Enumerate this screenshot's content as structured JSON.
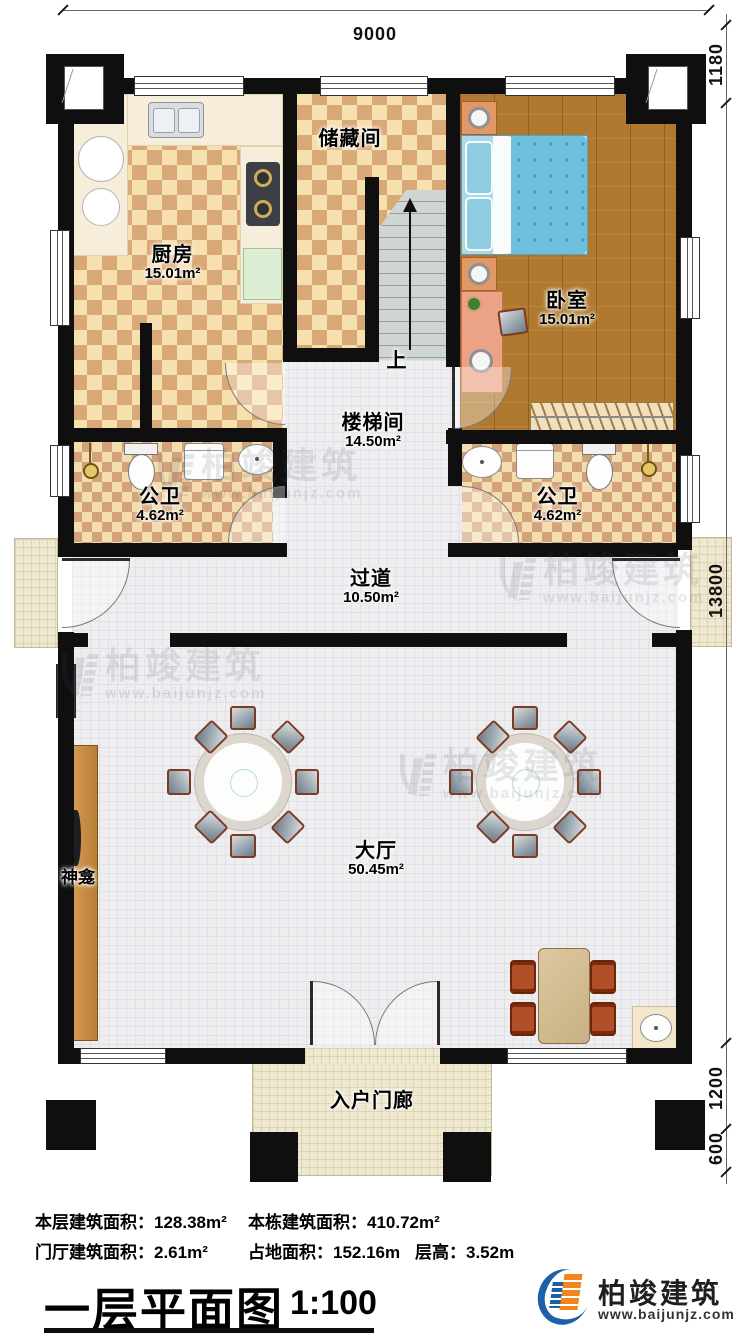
{
  "plan": {
    "dims": {
      "top": "9000",
      "right_upper": "1180",
      "right_main": "13800",
      "right_porch": "1200",
      "right_step": "600"
    },
    "rooms": {
      "kitchen": {
        "name": "厨房",
        "area": "15.01m²"
      },
      "storage": {
        "name": "储藏间"
      },
      "stairwell": {
        "name": "楼梯间",
        "area": "14.50m²"
      },
      "stairs_up": "上",
      "bedroom": {
        "name": "卧室",
        "area": "15.01m²"
      },
      "bath_left": {
        "name": "公卫",
        "area": "4.62m²"
      },
      "bath_right": {
        "name": "公卫",
        "area": "4.62m²"
      },
      "corridor": {
        "name": "过道",
        "area": "10.50m²"
      },
      "hall": {
        "name": "大厅",
        "area": "50.45m²"
      },
      "shrine": {
        "name": "神龛"
      },
      "porch": {
        "name": "入户门廊"
      }
    }
  },
  "stats": {
    "l1a": "本层建筑面积：128.38m²",
    "l1b": "本栋建筑面积：410.72m²",
    "l2a": "门厅建筑面积：2.61m²",
    "l2b": "占地面积：152.16m",
    "l2c": "层高：3.52m"
  },
  "title_block": {
    "title": "一层平面图",
    "scale": "1:100"
  },
  "brand": {
    "name": "柏竣建筑",
    "url": "www.baijunjz.com"
  },
  "watermark": {
    "name": "柏竣建筑",
    "url": "www.baijunjz.com"
  }
}
